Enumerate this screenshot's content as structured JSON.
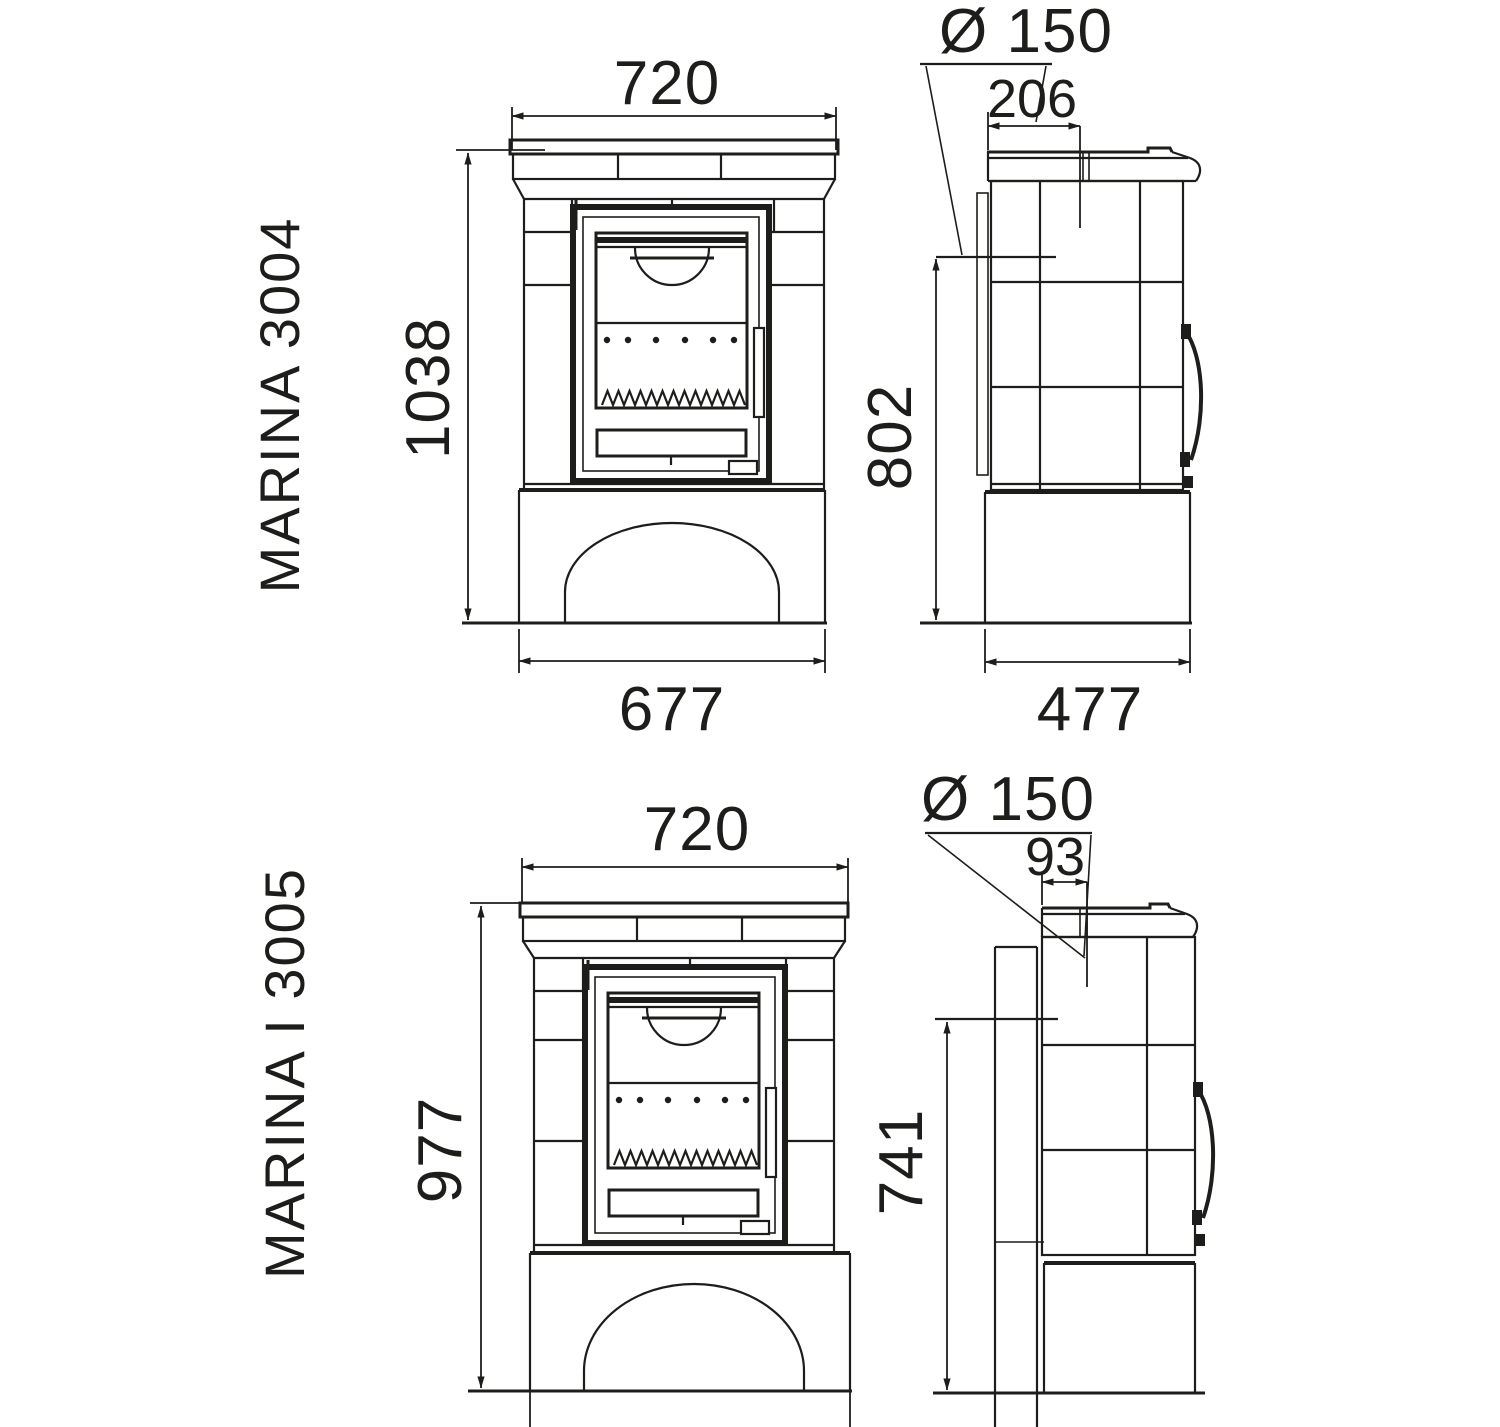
{
  "page": {
    "background": "#ffffff",
    "line_color": "#1d1d1b",
    "description": "Technical dimension drawing of two tiled wood stoves, front and side views"
  },
  "stoves": [
    {
      "model": "MARINA 3004",
      "front": {
        "width_top": "720",
        "height": "1038",
        "width_base": "677"
      },
      "side": {
        "flue_diameter": "Ø 150",
        "flue_offset_from_rear": "206",
        "rear_outlet_height": "802",
        "depth": "477"
      }
    },
    {
      "model": "MARINA I 3005",
      "front": {
        "width_top": "720",
        "height": "977"
      },
      "side": {
        "flue_diameter": "Ø 150",
        "flue_offset_from_rear": "93",
        "rear_outlet_height": "741"
      }
    }
  ]
}
